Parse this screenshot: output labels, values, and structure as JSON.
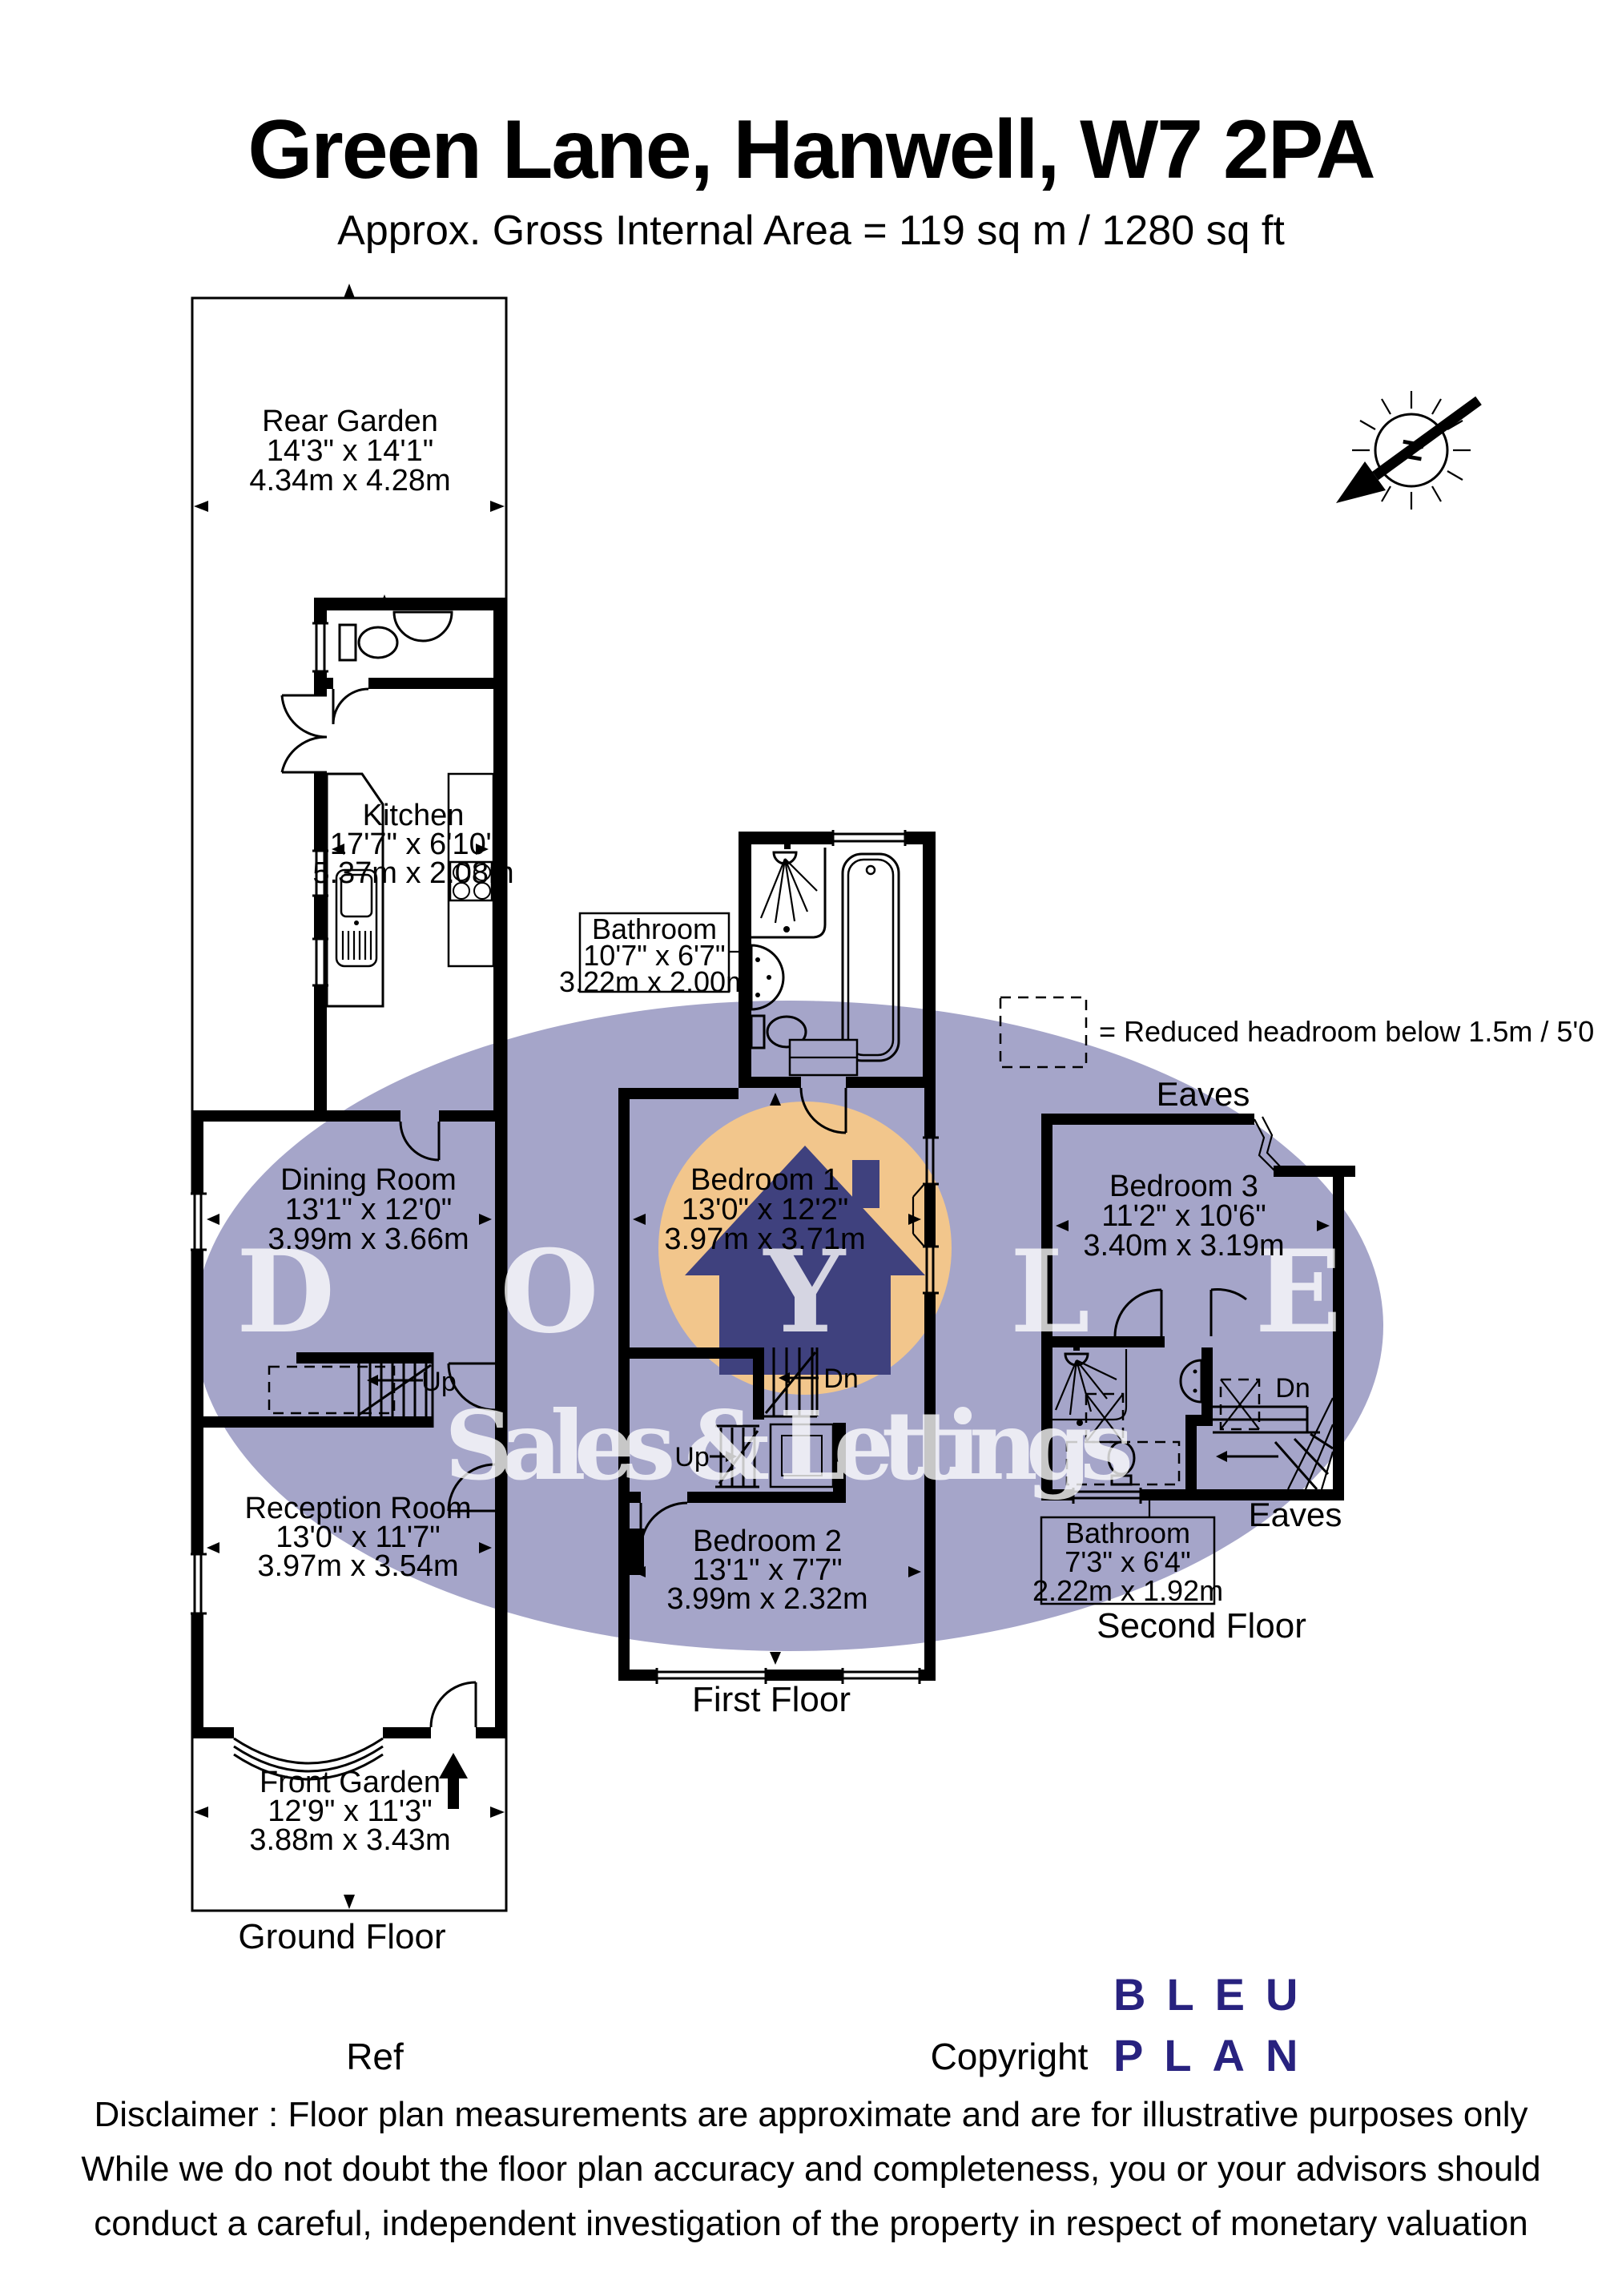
{
  "header": {
    "title": "Green Lane, Hanwell, W7 2PA",
    "subtitle": "Approx. Gross Internal Area = 119 sq m / 1280 sq ft"
  },
  "north": {
    "letter": "N"
  },
  "legend": {
    "text": "= Reduced headroom below 1.5m / 5'0"
  },
  "watermark": {
    "name": "DOYLE",
    "tagline": "Sales & Lettings"
  },
  "floors": {
    "ground": "Ground Floor",
    "first": "First Floor",
    "second": "Second Floor"
  },
  "labels": {
    "eaves": "Eaves",
    "up": "Up",
    "dn": "Dn"
  },
  "rooms": {
    "rear_garden": {
      "name": "Rear Garden",
      "imperial": "14'3\" x 14'1\"",
      "metric": "4.34m x 4.28m"
    },
    "kitchen": {
      "name": "Kitchen",
      "imperial": "17'7\" x 6'10\"",
      "metric": "5.37m x 2.08m"
    },
    "dining_room": {
      "name": "Dining Room",
      "imperial": "13'1\" x 12'0\"",
      "metric": "3.99m x 3.66m"
    },
    "reception_room": {
      "name": "Reception Room",
      "imperial": "13'0\" x 11'7\"",
      "metric": "3.97m x 3.54m"
    },
    "front_garden": {
      "name": "Front Garden",
      "imperial": "12'9\" x 11'3\"",
      "metric": "3.88m x 3.43m"
    },
    "bathroom_first": {
      "name": "Bathroom",
      "imperial": "10'7\" x 6'7\"",
      "metric": "3.22m x 2.00m"
    },
    "bedroom_1": {
      "name": "Bedroom 1",
      "imperial": "13'0\" x 12'2\"",
      "metric": "3.97m x 3.71m"
    },
    "bedroom_2": {
      "name": "Bedroom 2",
      "imperial": "13'1\" x 7'7\"",
      "metric": "3.99m x 2.32m"
    },
    "bedroom_3": {
      "name": "Bedroom 3",
      "imperial": "11'2\" x 10'6\"",
      "metric": "3.40m x 3.19m"
    },
    "bathroom_second": {
      "name": "Bathroom",
      "imperial": "7'3\" x 6'4\"",
      "metric": "2.22m x 1.92m"
    }
  },
  "footer": {
    "ref": "Ref",
    "copyright": "Copyright",
    "logo_line1": "BLEU",
    "logo_line2": "PLAN"
  },
  "disclaimer": {
    "line1": "Disclaimer : Floor plan measurements are approximate and are for illustrative purposes only",
    "line2": "While we do not doubt the floor plan accuracy and completeness, you or your advisors should",
    "line3": "conduct a careful, independent investigation of the property in respect of monetary valuation"
  },
  "colors": {
    "watermark_ellipse": "#a5a5c9",
    "watermark_circle": "#f2c68c",
    "watermark_house": "#3f417e",
    "logo_navy": "#28227f"
  }
}
